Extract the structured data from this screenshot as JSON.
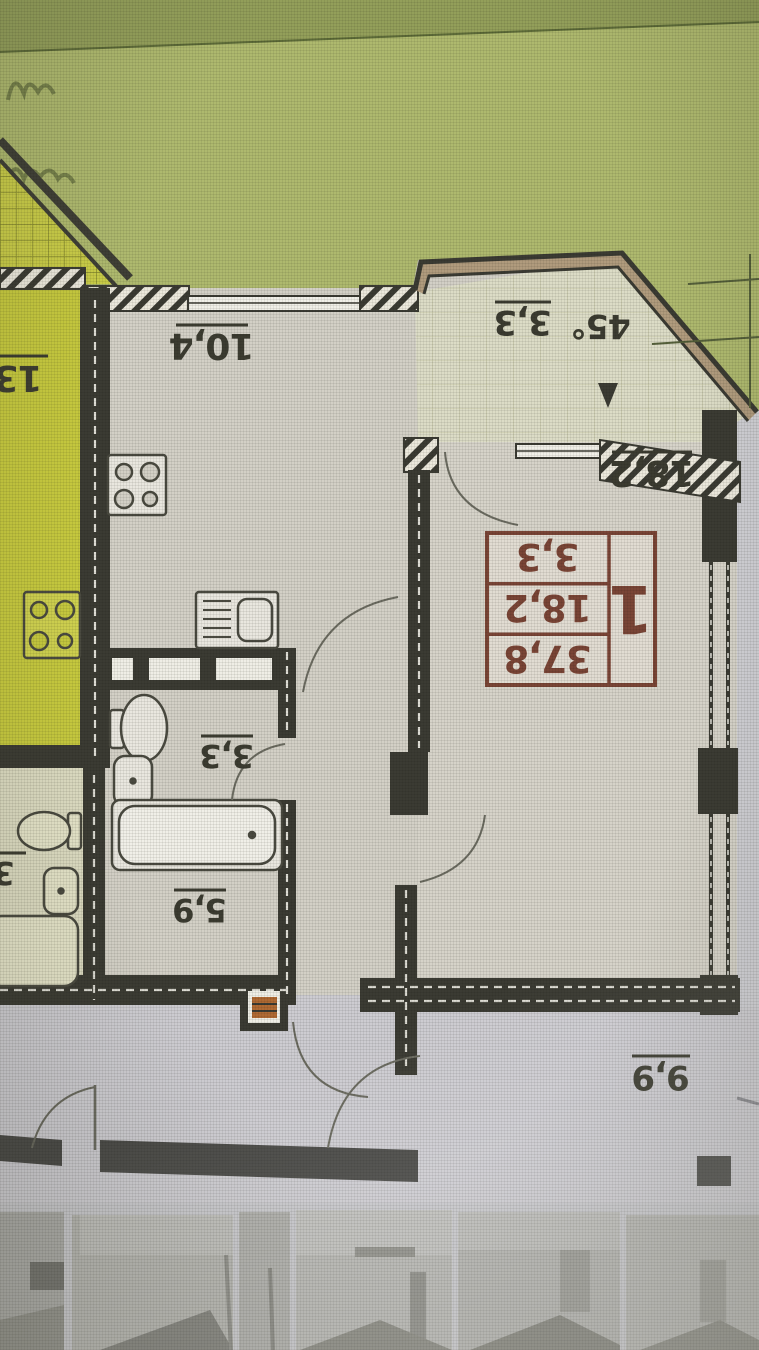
{
  "plan": {
    "labels": {
      "kitchen_area": "10,4",
      "wc_area": "3,3",
      "bathroom_area": "5,9",
      "living_room_area": "18,2",
      "balcony_area": "3,3",
      "balcony_angle": "45°",
      "corridor_area": "9,9",
      "neighbor_room_area_partial": "13,",
      "neighbor_bath_area_partial": "3"
    },
    "stamp": {
      "apartment_number": "1",
      "total_area": "37,8",
      "living_area": "18,2",
      "kitchen_area": "3,3"
    },
    "colors": {
      "background_green": "#aeb96e",
      "neighbor_room_yellow": "#c6c93e",
      "walls_dark": "#3b3b33",
      "stamp_red": "#7a4536",
      "room_fill": "#d3d0c6",
      "corridor_gray": "#cdccd1"
    }
  },
  "gallery": {
    "thumbnail_count": "6"
  }
}
